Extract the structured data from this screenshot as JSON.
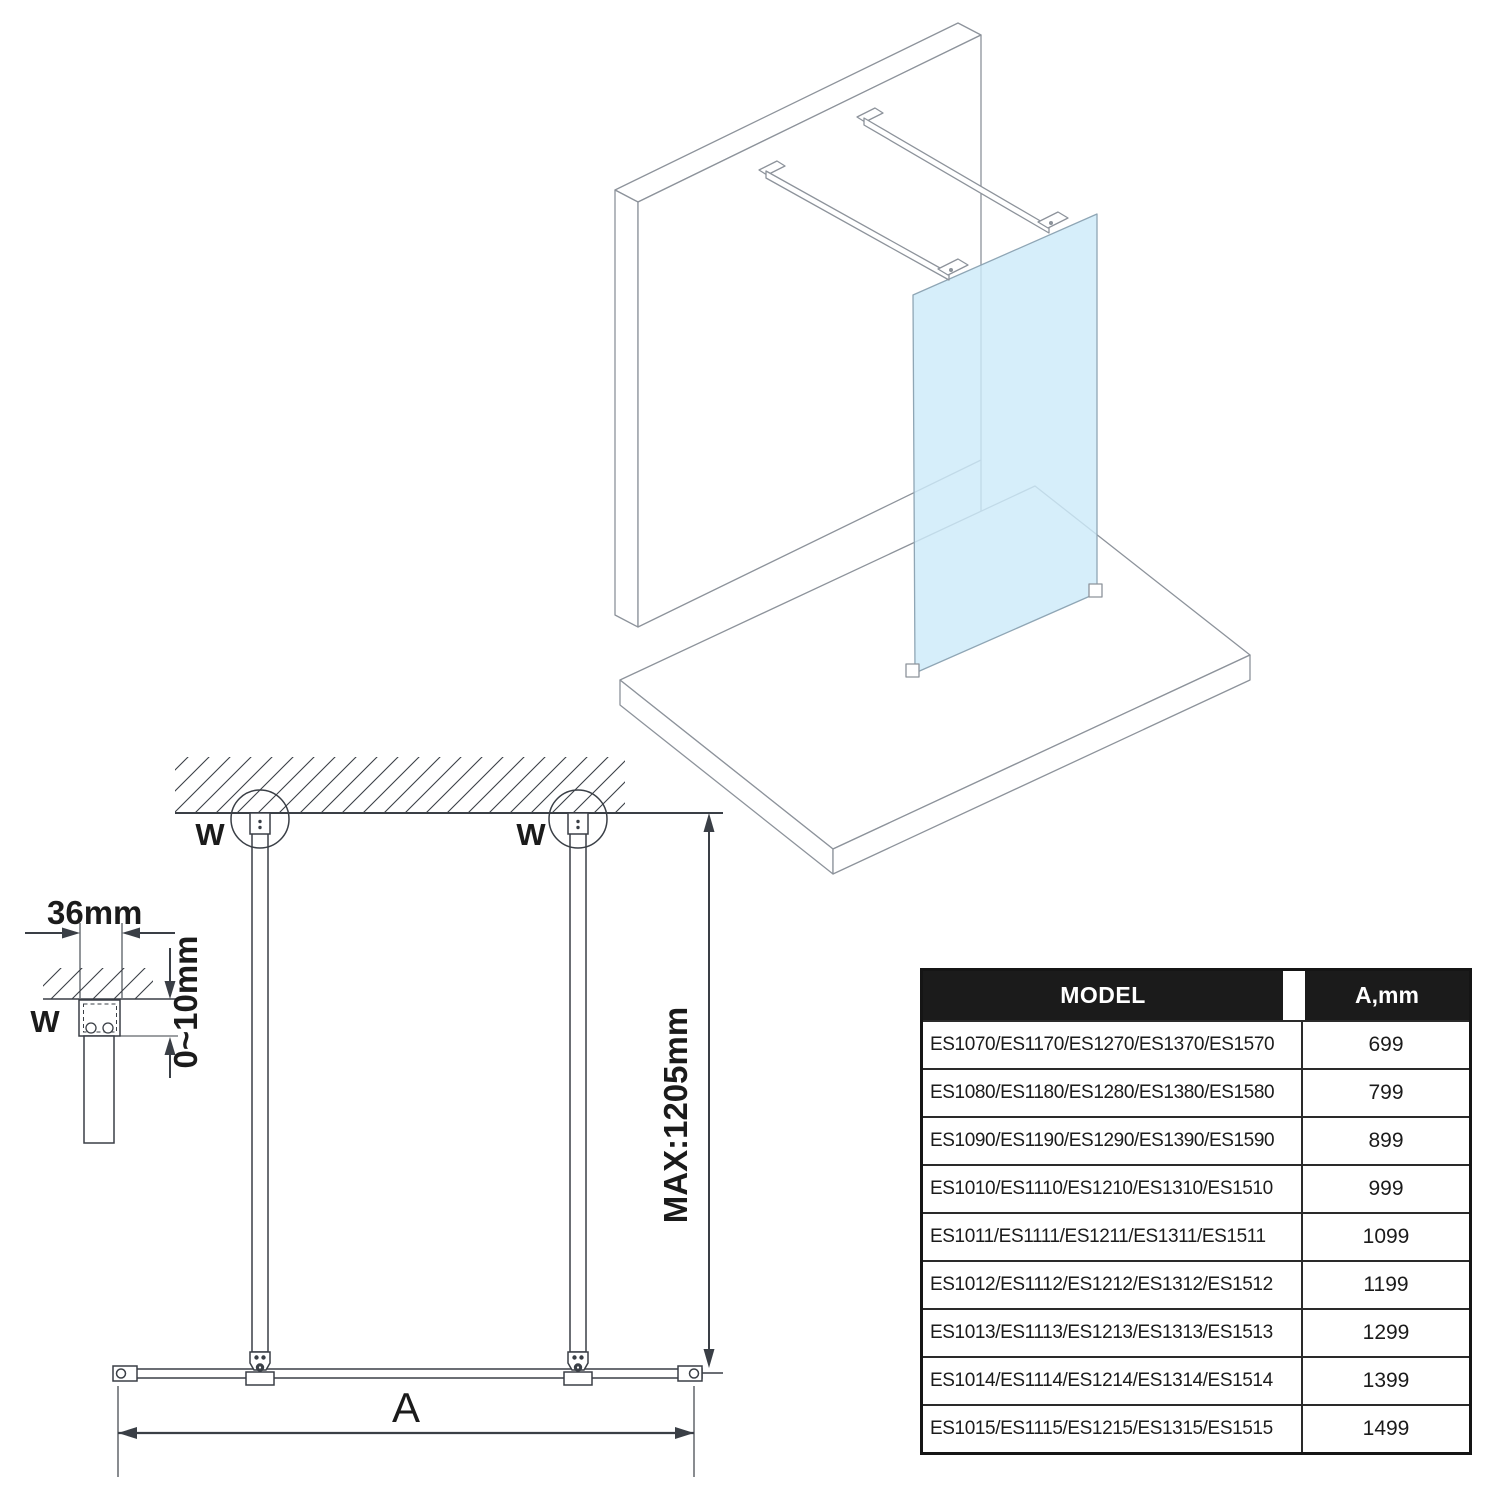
{
  "drawing": {
    "labels": {
      "wall_fixing": "W",
      "bracket_width": "36mm",
      "ceiling_gap": "0~10mm",
      "max_bar_length": "MAX:1205mm",
      "panel_width": "A"
    }
  },
  "table": {
    "header": {
      "model": "MODEL",
      "a": "A,mm"
    },
    "rows": [
      {
        "model": "ES1070/ES1170/ES1270/ES1370/ES1570",
        "a": "699"
      },
      {
        "model": "ES1080/ES1180/ES1280/ES1380/ES1580",
        "a": "799"
      },
      {
        "model": "ES1090/ES1190/ES1290/ES1390/ES1590",
        "a": "899"
      },
      {
        "model": "ES1010/ES1110/ES1210/ES1310/ES1510",
        "a": "999"
      },
      {
        "model": "ES1011/ES1111/ES1211/ES1311/ES1511",
        "a": "1099"
      },
      {
        "model": "ES1012/ES1112/ES1212/ES1312/ES1512",
        "a": "1199"
      },
      {
        "model": "ES1013/ES1113/ES1213/ES1313/ES1513",
        "a": "1299"
      },
      {
        "model": "ES1014/ES1114/ES1214/ES1314/ES1514",
        "a": "1399"
      },
      {
        "model": "ES1015/ES1115/ES1215/ES1315/ES1515",
        "a": "1499"
      }
    ]
  },
  "colors": {
    "line_2d": "#3a3f46",
    "line_3d": "#8d939b",
    "glass_fill": "#cdeaf9",
    "glass_stroke": "#8fa6b5",
    "table_header_bg": "#1b1b1b",
    "table_header_text": "#ffffff"
  }
}
